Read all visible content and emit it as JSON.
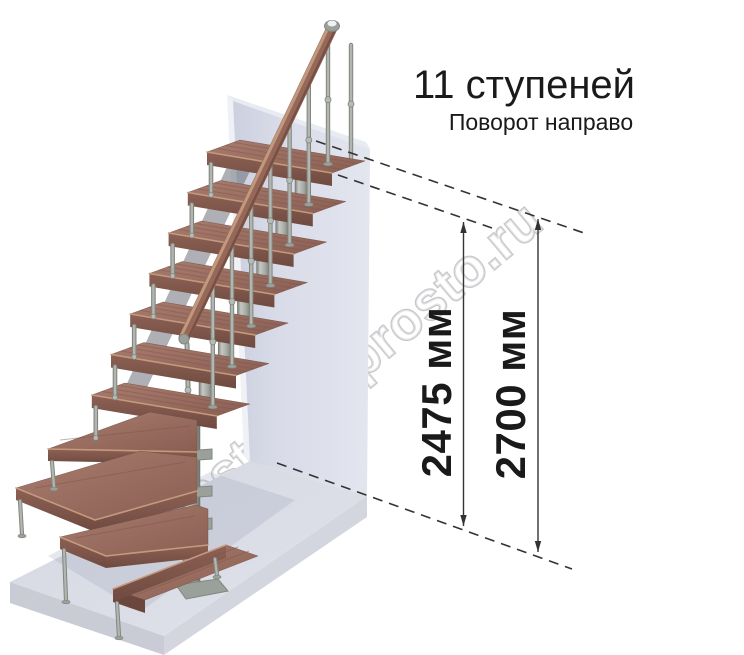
{
  "header": {
    "title": "11 ступеней",
    "subtitle": "Поворот направо"
  },
  "dimensions": {
    "height_to_top_step": {
      "label": "2475 мм",
      "value": 2475,
      "unit": "мм"
    },
    "height_to_ceiling": {
      "label": "2700 мм",
      "value": 2700,
      "unit": "мм"
    }
  },
  "staircase": {
    "steps_total": 11,
    "turn_direction": "направо",
    "straight_upper_steps": 7,
    "winder_steps": 3,
    "bottom_steps": 1
  },
  "watermark": {
    "text": "lestnicy-prosto.ru"
  },
  "colors": {
    "wall_front": "#d8dbe7",
    "wall_edge": "#f0f1f6",
    "wall_top": "#e9ebf2",
    "floor_side_left": "#c9ccd4",
    "floor_side_right": "#d3d6de",
    "wood_top": "#9b6e61",
    "wood_front": "#7d544a",
    "wood_nose": "#c49a7e",
    "wood_streak": "#7f5549",
    "rail": "#96685a",
    "rail_light": "#c9a183",
    "rail_dark": "#5f3d33",
    "metal": "#b2b6b0",
    "metal_mid": "#9aa09a",
    "metal_dark": "#82867f",
    "shadow": "#5d626c",
    "shadow_soft": "#a2a8ba",
    "dim": "#333333",
    "text": "#1a1a1a",
    "watermark_stroke": "#c2c2c6"
  }
}
